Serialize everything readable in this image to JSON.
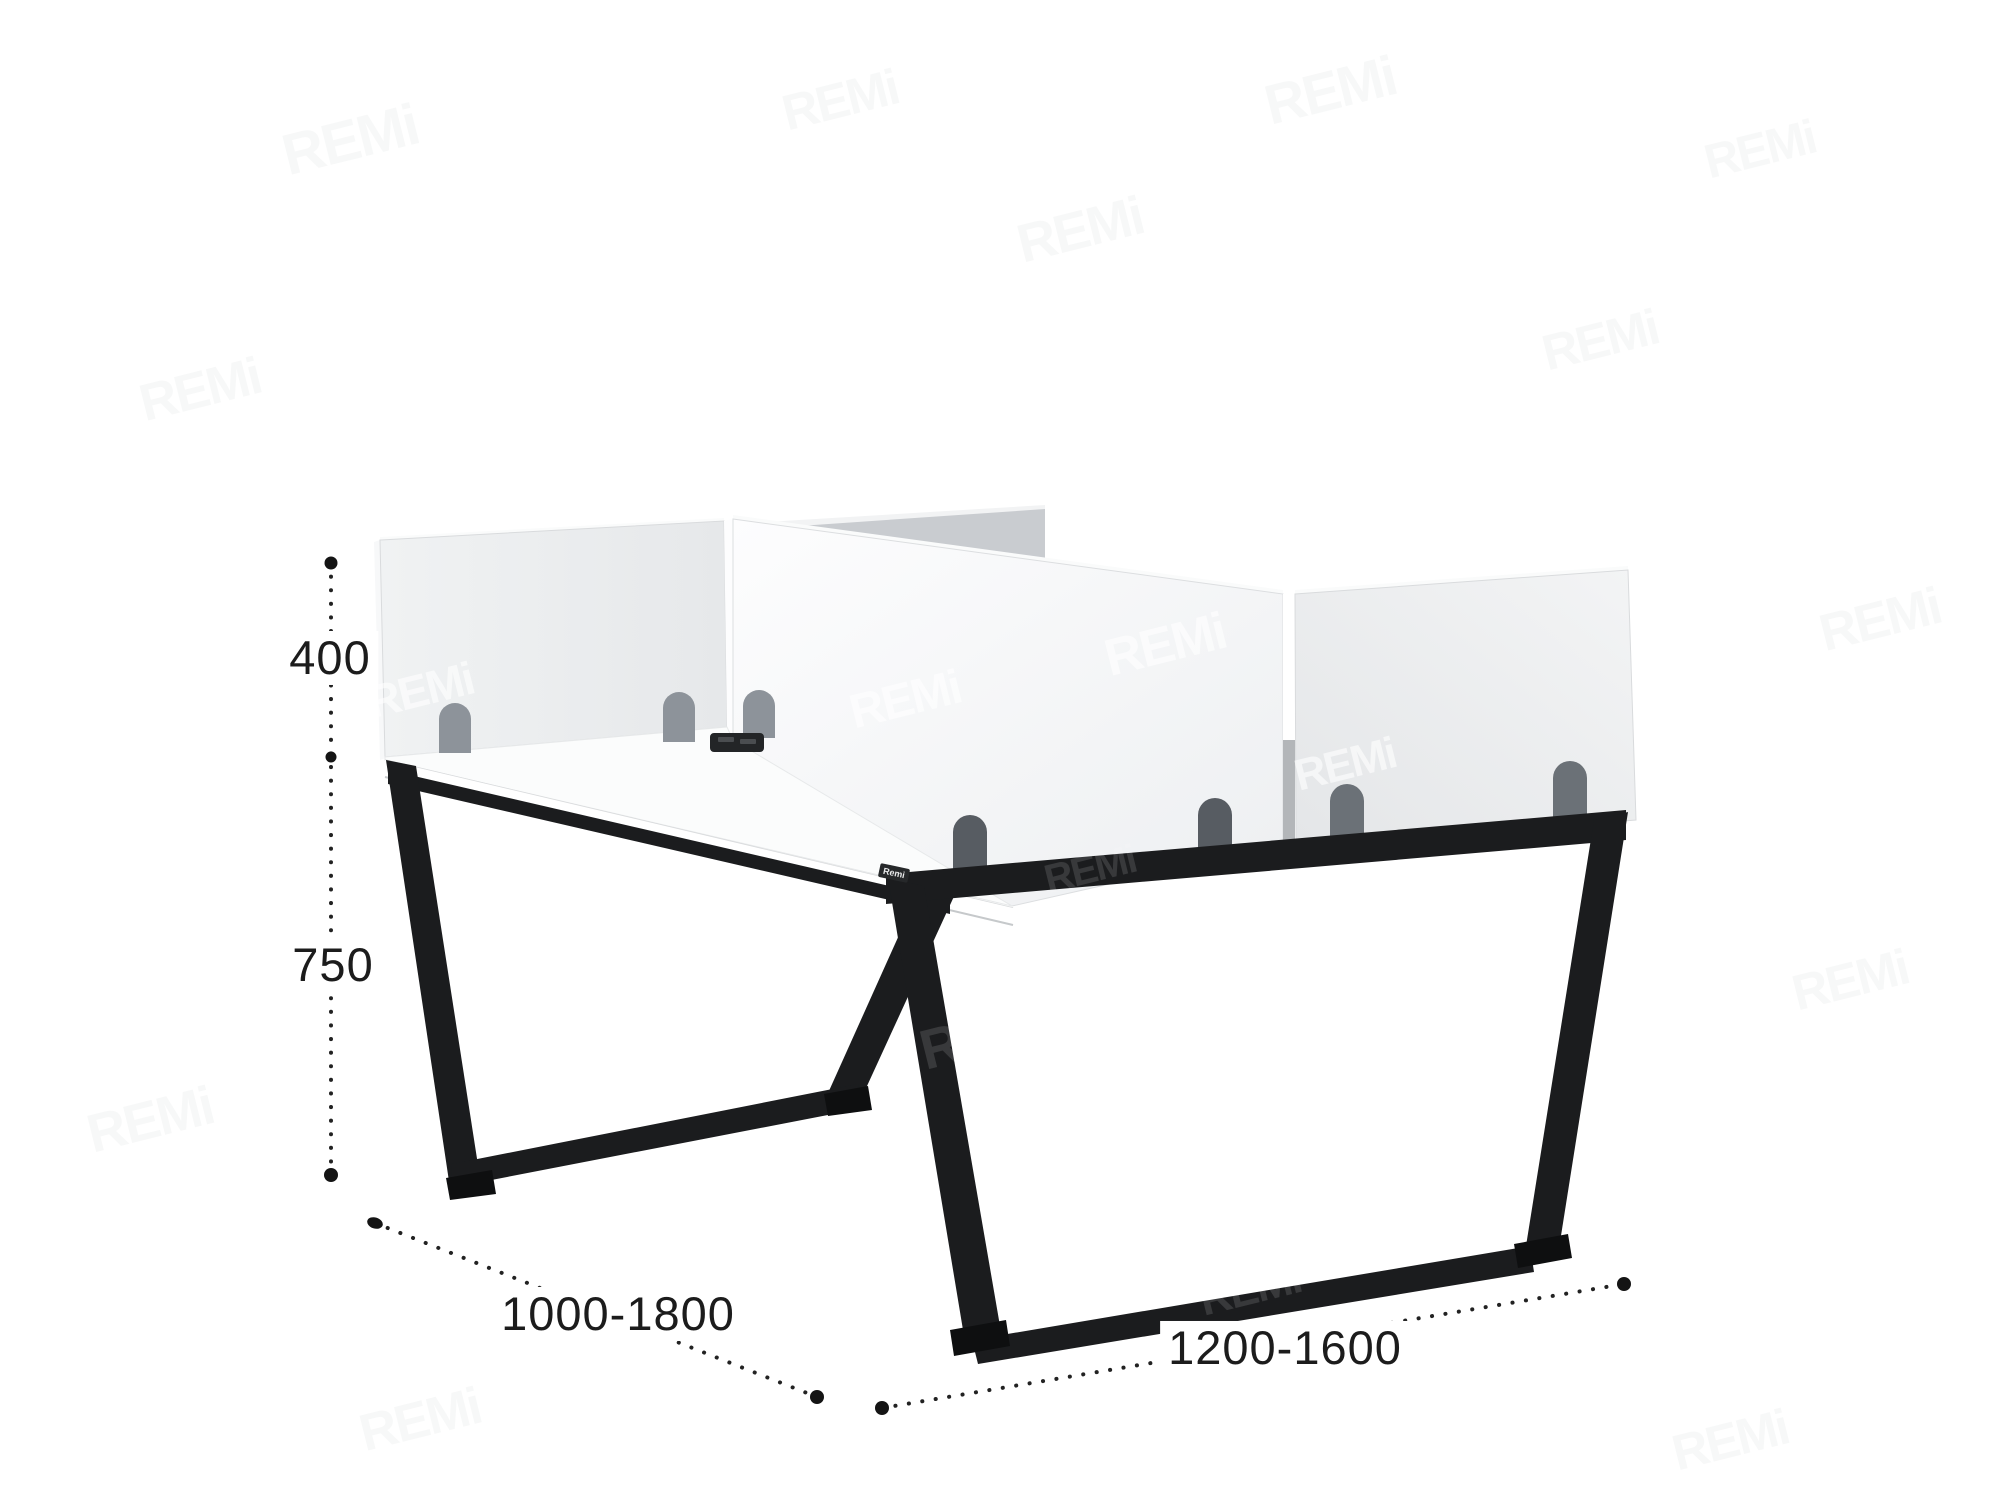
{
  "image": {
    "description": "Dimensioned 3D rendering of a two-person office bench desk with white privacy screen panels and black trapezoid sled legs",
    "watermark_text": "REMi",
    "edge_logo_text": "Remi"
  },
  "dimensions": {
    "screen_height": "400",
    "desk_height": "750",
    "depth_range": "1000-1800",
    "width_range": "1200-1600"
  },
  "colors": {
    "background": "#ffffff",
    "panel_light": "#eaecee",
    "panel_bright": "#f7f8f9",
    "panel_top_strip": "#fafbfb",
    "panel_shadow_wedge": "#c9ccd0",
    "gap_lower": "#b3b6b9",
    "desk_top": "#fbfcfc",
    "desk_front": "#ffffff",
    "desk_edge_line": "#c6c9cb",
    "leg_black": "#1b1c1e",
    "leg_foot": "#0e0f10",
    "arch_gray": "#8d939a",
    "arch_mid": "#6b7177",
    "arch_dark": "#575c62",
    "grommet": "#232527",
    "grommet_slot": "#4a4d50",
    "dimension_ink": "#222222"
  }
}
